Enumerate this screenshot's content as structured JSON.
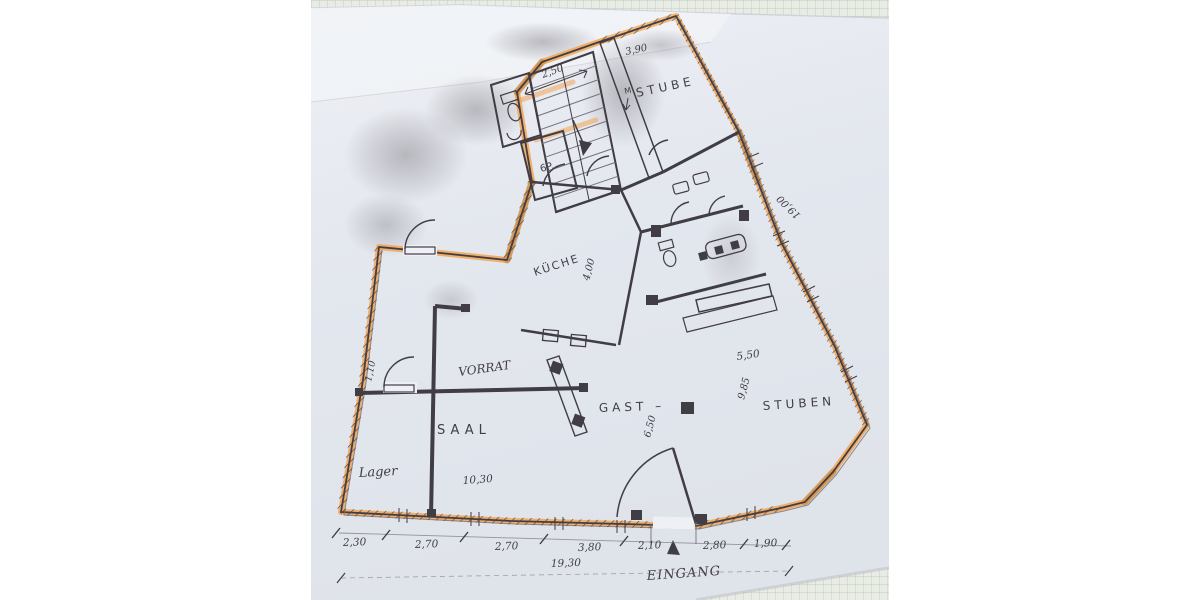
{
  "meta": {
    "description": "Photograph of a hand-drawn, photocopied floor plan on grey-blue paper lying on green graph paper; exterior walls traced with orange highlighter"
  },
  "colors": {
    "page_bg": "#ffffff",
    "paper": "#e3e7ee",
    "paper_light": "#f1f3f7",
    "grid_bg": "#e9ece4",
    "grid_line": "#b4c3b0",
    "pencil": "#413d45",
    "pencil_soft": "#75717a",
    "highlighter": "#f2a452",
    "highlighter_dark": "#c07f3a",
    "smudge": "#8f8c94"
  },
  "rooms": {
    "stube": "STUBE",
    "stube_mark": "M",
    "kueche": "KÜCHE",
    "vorrat": "VORRAT",
    "saal": "SAAL",
    "lager": "Lager",
    "gast": "GAST  –",
    "stuben": "STUBEN",
    "stair_store": "6P."
  },
  "entrance": {
    "label": "EINGANG"
  },
  "dims": {
    "stair_top": "2,50",
    "stube_top": "3,90",
    "right_side": "19,00",
    "kueche_depth": "4,00",
    "gast_top": "5,50",
    "gast_depth": "9,85",
    "gast_inner": "6,50",
    "saal_door": "1,10",
    "saal_width": "10,30",
    "total_width": "19,30",
    "chain": [
      "2,30",
      "2,70",
      "2,70",
      "3,80",
      "2,10",
      "2,80",
      "1,90"
    ]
  }
}
